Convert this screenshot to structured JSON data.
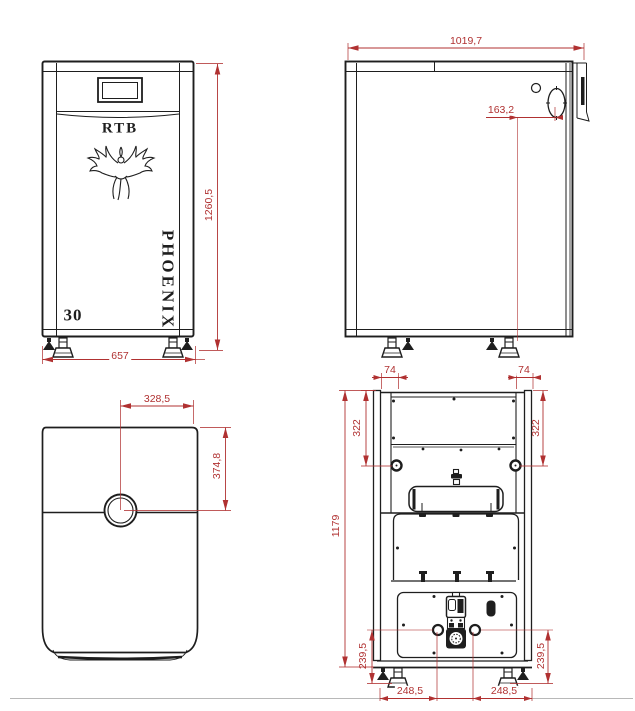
{
  "meta": {
    "drawing_type": "boiler technical drawing, four orthographic views",
    "views_present": [
      "front",
      "side",
      "top",
      "back"
    ]
  },
  "colors": {
    "line": "#1e1e1e",
    "dimension": "#b03131",
    "background": "#ffffff"
  },
  "branding": {
    "brand": "RTB",
    "model": "PHOENIX",
    "power_label": "30"
  },
  "views": {
    "front": {
      "name": "front view",
      "dim_height": "1260,5",
      "dim_width": "657"
    },
    "side": {
      "name": "side view",
      "dim_depth": "1019,7",
      "dim_flue_offset": "163,2"
    },
    "top": {
      "name": "top view",
      "dim_flue_from_side": "328,5",
      "dim_flue_from_front": "374,8"
    },
    "back": {
      "name": "back view",
      "dim_conn_offset_left": "74",
      "dim_conn_offset_right": "74",
      "dim_conn_drop_left": "322",
      "dim_conn_drop_right": "322",
      "dim_total_height": "1179",
      "dim_lower_conn_left": "239,5",
      "dim_lower_conn_right": "239,5",
      "dim_bottom_left": "248,5",
      "dim_bottom_right": "248,5"
    }
  }
}
